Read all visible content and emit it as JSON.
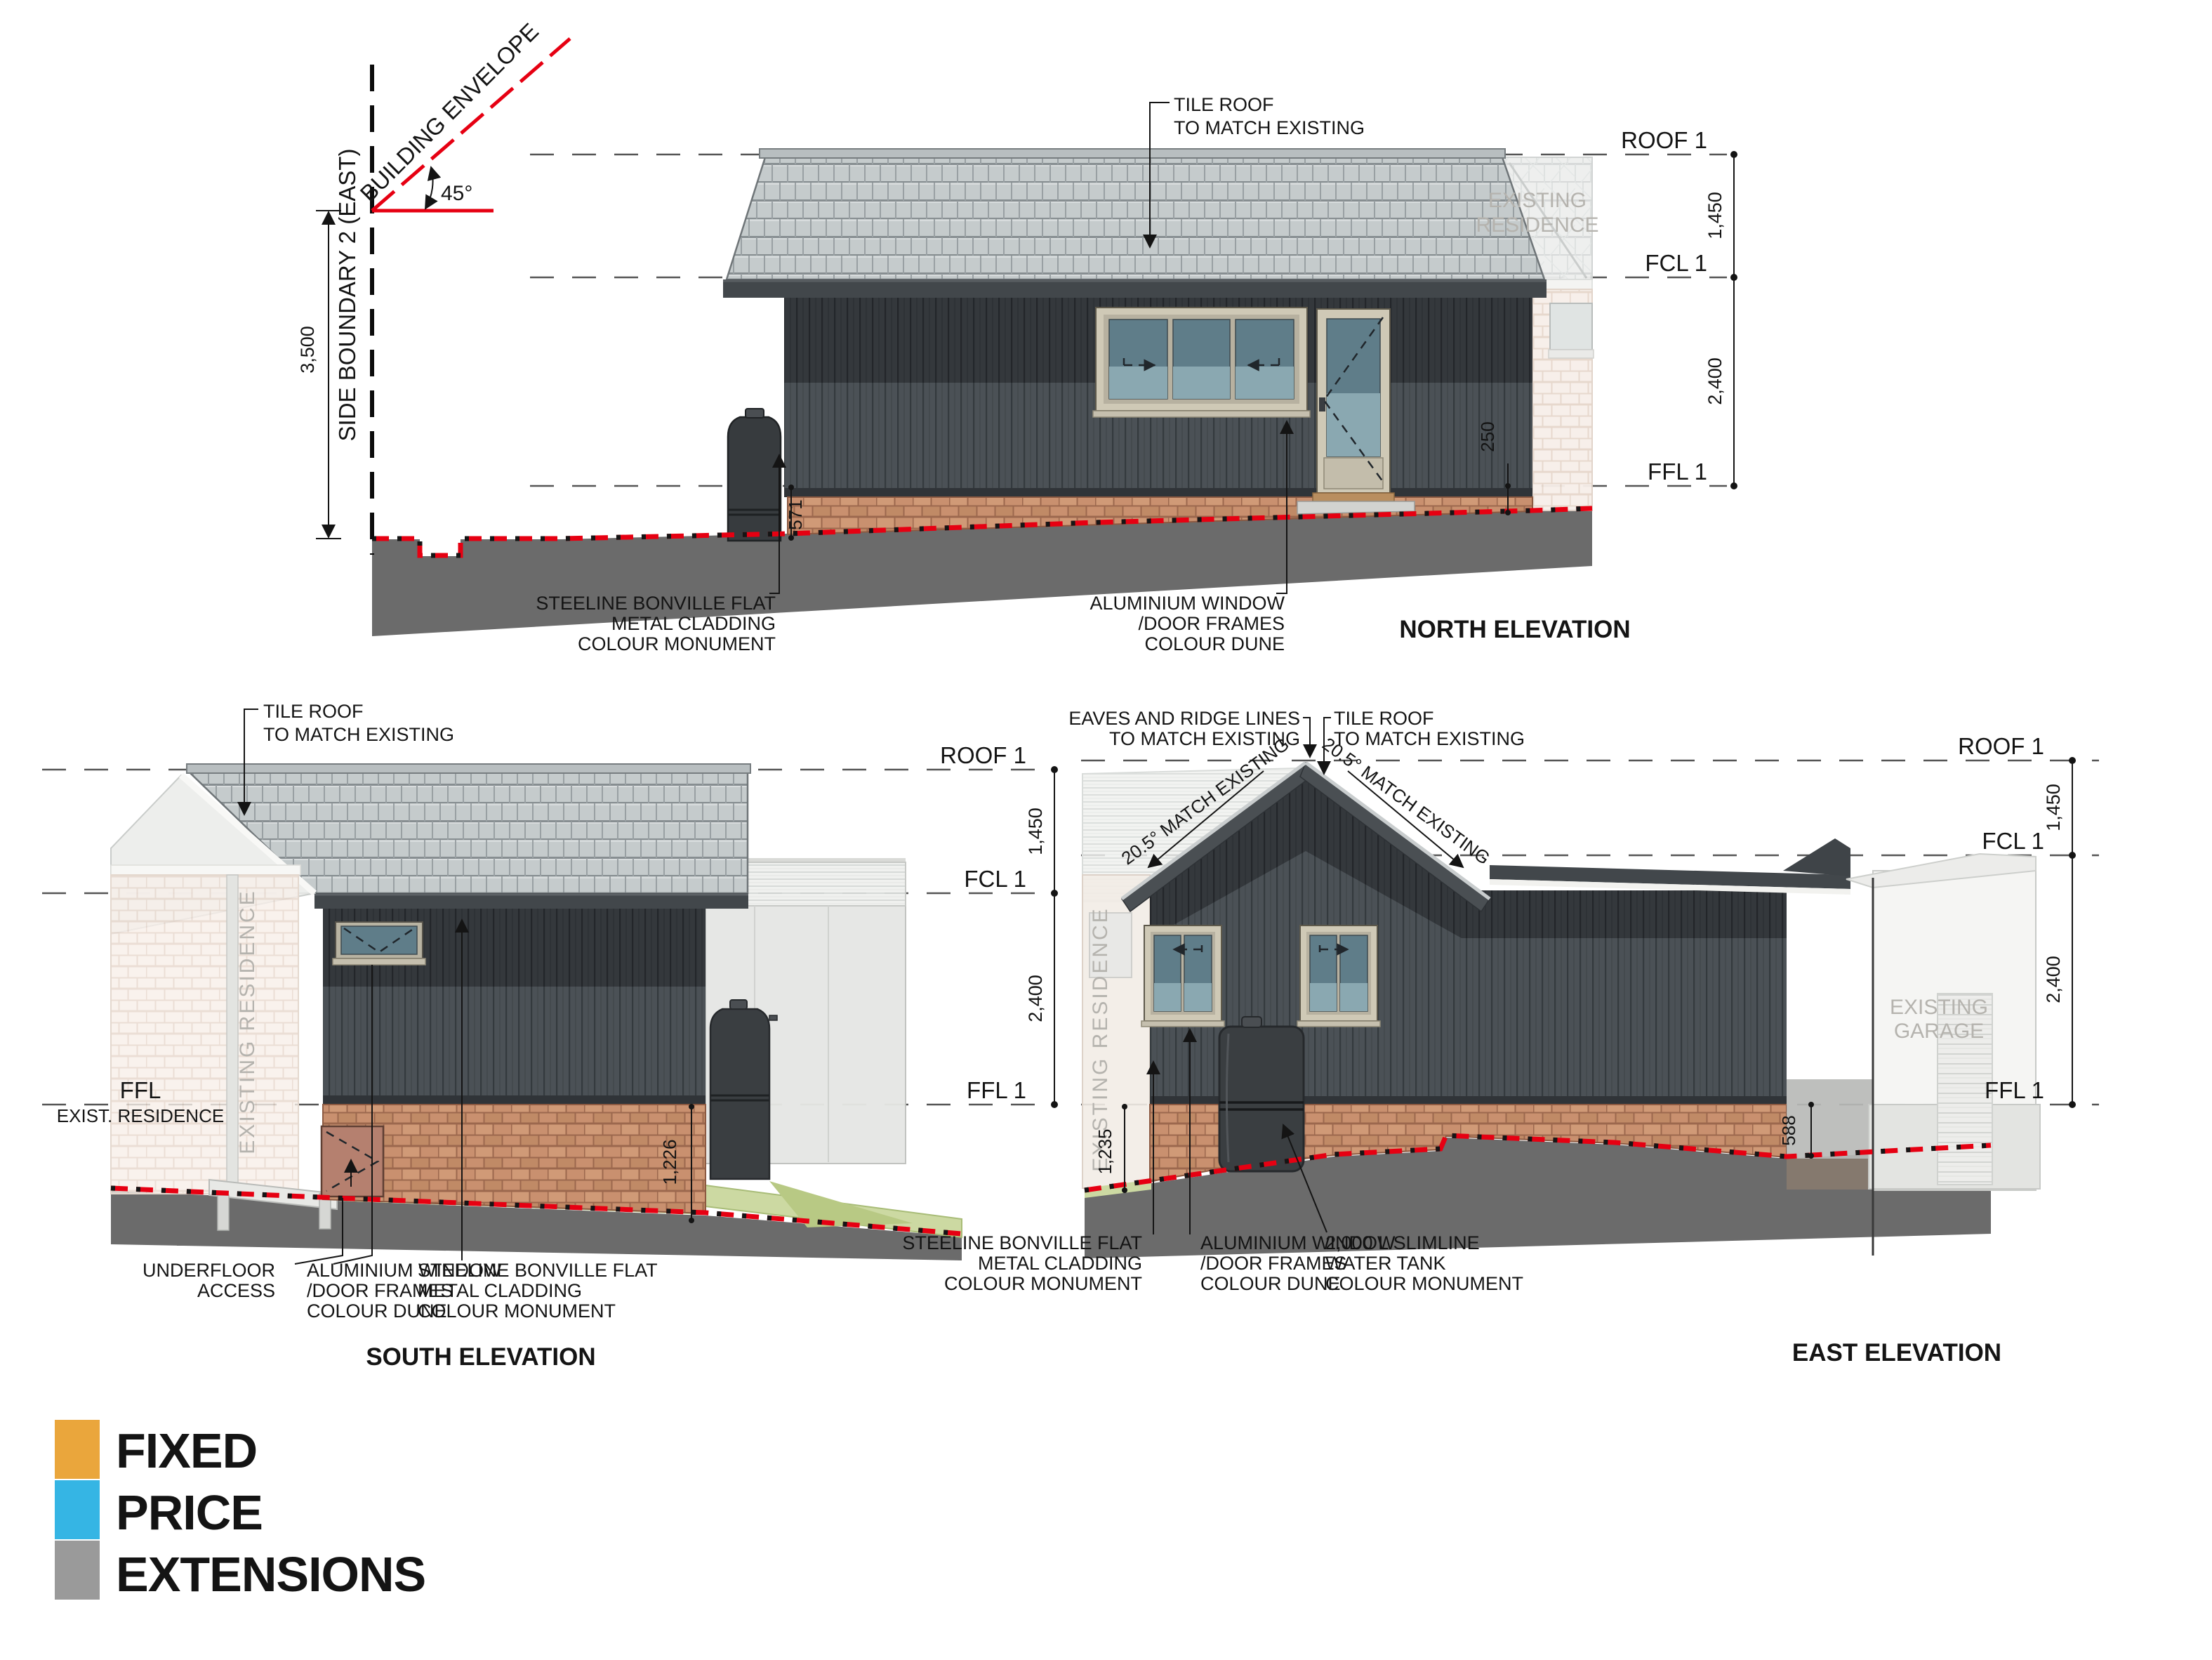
{
  "sheet": {
    "background": "#ffffff",
    "accent_red": "#e60012",
    "cladding_dark": "#34383c",
    "cladding_light": "#4b5156",
    "brick": "#c9906f",
    "tile_grey": "#c5cbcc"
  },
  "north": {
    "title": "NORTH ELEVATION",
    "levels": {
      "roof": "ROOF 1",
      "fcl": "FCL 1",
      "ffl": "FFL 1"
    },
    "dims": {
      "roof_to_fcl": "1,450",
      "fcl_to_ffl": "2,400",
      "ground_left": "571",
      "ground_right": "250",
      "boundary_height": "3,500",
      "envelope_angle": "45°"
    },
    "boundary_label": "SIDE BOUNDARY 2 (EAST)",
    "envelope_label": "BUILDING ENVELOPE",
    "roof_note": [
      "TILE ROOF",
      "TO MATCH EXISTING"
    ],
    "cladding_note": [
      "STEELINE BONVILLE FLAT",
      "METAL CLADDING",
      "COLOUR MONUMENT"
    ],
    "window_note": [
      "ALUMINIUM WINDOW",
      "/DOOR FRAMES",
      "COLOUR DUNE"
    ],
    "ghost_label": [
      "EXISTING",
      "RESIDENCE"
    ]
  },
  "south": {
    "title": "SOUTH ELEVATION",
    "levels": {
      "roof": "ROOF 1",
      "fcl": "FCL 1",
      "ffl": "FFL 1"
    },
    "dims": {
      "roof_to_fcl": "1,450",
      "fcl_to_ffl": "2,400",
      "ground": "1,226"
    },
    "ffl_exist": [
      "FFL",
      "EXIST. RESIDENCE"
    ],
    "roof_note": [
      "TILE ROOF",
      "TO MATCH EXISTING"
    ],
    "underfloor_note": [
      "UNDERFLOOR",
      "ACCESS"
    ],
    "window_note": [
      "ALUMINIUM WINDOW",
      "/DOOR FRAMES",
      "COLOUR DUNE"
    ],
    "cladding_note": [
      "STEELINE BONVILLE FLAT",
      "METAL CLADDING",
      "COLOUR MONUMENT"
    ],
    "ghost_label_vertical": "EXISTING RESIDENCE"
  },
  "east": {
    "title": "EAST ELEVATION",
    "levels": {
      "roof": "ROOF 1",
      "fcl": "FCL 1",
      "ffl": "FFL 1"
    },
    "dims": {
      "roof_to_fcl": "1,450",
      "fcl_to_ffl": "2,400",
      "ground_left": "1,235",
      "ground_right": "588"
    },
    "eaves_note": [
      "EAVES AND RIDGE LINES",
      "TO MATCH EXISTING"
    ],
    "roof_note": [
      "TILE ROOF",
      "TO MATCH EXISTING"
    ],
    "pitch_left": "20.5°  MATCH EXISTING",
    "pitch_right": "20.5°  MATCH EXISTING",
    "cladding_note": [
      "STEELINE BONVILLE FLAT",
      "METAL CLADDING",
      "COLOUR MONUMENT"
    ],
    "window_note": [
      "ALUMINIUM WINDOW",
      "/DOOR FRAMES",
      "COLOUR DUNE"
    ],
    "tank_note": [
      "2,000 L SLIMLINE",
      "WATER TANK",
      "COLOUR MONUMENT"
    ],
    "ghost_residence_vertical": "EXISTING RESIDENCE",
    "ghost_garage": [
      "EXISTING",
      "GARAGE"
    ]
  },
  "logo": {
    "line1": "FIXED",
    "line2": "PRICE",
    "line3": "EXTENSIONS",
    "color1": "#eaa63c",
    "color2": "#35b5e4",
    "color3": "#9a9a9a"
  }
}
